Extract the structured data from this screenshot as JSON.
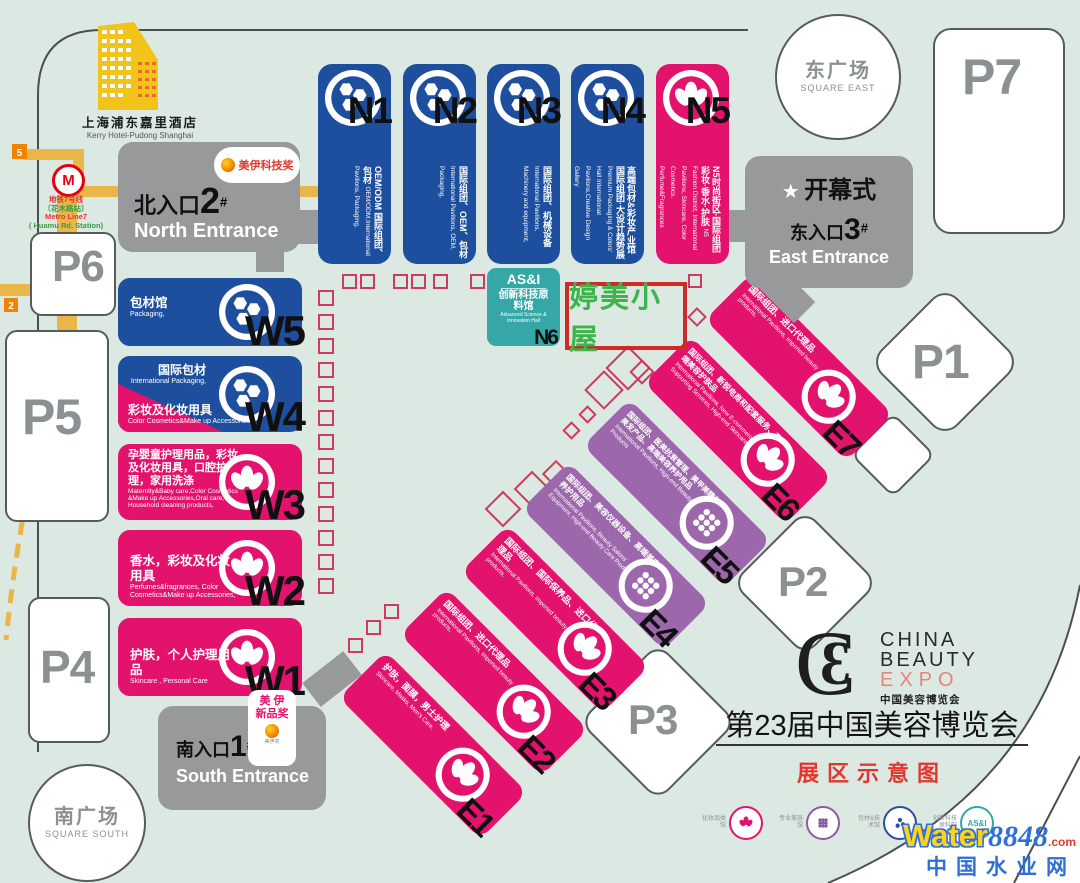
{
  "map_title": "第23届中国美容博览会",
  "map_subtitle": "展区示意图",
  "logo": {
    "mono_c": "C",
    "mono_b": "3",
    "line1": "CHINA",
    "line2": "BEAUTY",
    "line3": "EXPO",
    "line4": "中国美容博览会"
  },
  "hotel": {
    "zh": "上海浦东嘉里酒店",
    "en": "Kerry Hotel-Pudong Shanghai"
  },
  "metro": {
    "zh1": "地铁7号线",
    "zh2": "〔花木路站〕",
    "en1": "Metro Line7",
    "en2": "( Huamu Rd. Station)",
    "logo": "M",
    "badge5": "5",
    "badge1": "1",
    "badge2": "2"
  },
  "squares": {
    "east_zh": "东广场",
    "east_en": "SQUARE EAST",
    "south_zh": "南广场",
    "south_en": "SQUARE SOUTH"
  },
  "parking": {
    "p1": "P1",
    "p2": "P2",
    "p3": "P3",
    "p4": "P4",
    "p5": "P5",
    "p6": "P6",
    "p7": "P7"
  },
  "entrances": {
    "north": {
      "zh": "北入口",
      "num": "2",
      "sup": "#",
      "en": "North Entrance"
    },
    "east": {
      "star": "★",
      "ceremony": "开幕式",
      "zh": "东入口",
      "num": "3",
      "sup": "#",
      "en": "East Entrance"
    },
    "south": {
      "zh": "南入口",
      "num": "1",
      "sup": "#",
      "en": "South Entrance"
    }
  },
  "awards": {
    "tech": {
      "name": "美伊科技奖"
    },
    "new": {
      "line1": "美 伊",
      "line2": "新品奖",
      "tiny": "美伊奖"
    }
  },
  "highlight": {
    "text": "婷美小屋"
  },
  "halls": {
    "n": [
      {
        "id": "N1",
        "zh": "OEM/ODM 国际组团、包材",
        "en": "OEM/ODM,International Pavilions, Packaging,"
      },
      {
        "id": "N2",
        "zh": "国际组团、OEM、包材",
        "en": "International Pavilions, OEM, Packaging,"
      },
      {
        "id": "N3",
        "zh": "国际组团、机械设备",
        "en": "International Pavilions, Machinery and equipment,"
      },
      {
        "id": "N4",
        "zh": "高端包材&彩妆产业馆 国际组团·大设计趋势展",
        "en": "Premium Packaging & Colors' Hall International Pavilions,Creative Design Gallery"
      },
      {
        "id": "N5",
        "zh": "N5时尚街区·国际组团 彩妆·香水·护肤",
        "en": "N5 Fashion District, International Pavilions, Skincare, Color Cosmetics, Perfume&Fragrances"
      }
    ],
    "n6": {
      "brand": "AS&I",
      "zh1": "创新科技",
      "zh2": "原料馆",
      "en": "Advanced Science & Innovation Hall",
      "id": "N6"
    },
    "w": [
      {
        "id": "W5",
        "zh": "包材馆",
        "en": "Packaging,"
      },
      {
        "id": "W4",
        "zh2": "国际包材",
        "en2": "International Packaging,",
        "zh": "彩妆及化妆用具",
        "en": "Color Cosmetics&Make up Accessories,"
      },
      {
        "id": "W3",
        "zh": "孕婴童护理用品，彩妆及化妆用具，口腔护理，家用洗涤",
        "en": "Maternity&Baby care,Color Cosmetics &Make up Accessories,Oral care, Household cleaning products,"
      },
      {
        "id": "W2",
        "zh": "香水，彩妆及化妆用具",
        "en": "Perfumes&fragrances, Color Cosmetics&Make up Accessories,"
      },
      {
        "id": "W1",
        "zh": "护肤，个人护理用品",
        "en": "Skincare , Personal Care"
      }
    ],
    "e": [
      {
        "id": "E1",
        "zh": "护肤，面膜，男士护理",
        "en": "Skincare, Masks, Men's Care,"
      },
      {
        "id": "E2",
        "zh": "国际组团、进口代理品",
        "en": "International Pavilions, Imported beauty products,"
      },
      {
        "id": "E3",
        "zh": "国际组团、国际保养品、进口代理品",
        "en": "International Pavilions, Imported beauty products,"
      },
      {
        "id": "E4",
        "zh": "国际组团、美容仪器设备、高端美容养护用品",
        "en": "International Pavilions, Beauty Salons' Equipment, High-end Beauty Care Products"
      },
      {
        "id": "E5",
        "zh": "国际组团、医美抗衰管理、美甲美睫和美发产品、高端美容养护用品",
        "en": "International Pavilions, High-end Beauty Care Products"
      },
      {
        "id": "E6",
        "zh": "国际组团、新锐电商和配套服务、高端美容护肤品",
        "en": "International Pavilions, New E-commerce & Supporting Services, High-end Skincare"
      },
      {
        "id": "E7",
        "zh": "国际组团、进口代理品",
        "en": "International Pavilions, Imported beauty products,"
      }
    ]
  },
  "footer_logos": [
    {
      "label": "化妆品类馆"
    },
    {
      "label": "专业美容馆"
    },
    {
      "label": "包材&技术馆"
    },
    {
      "label": "创新科技原料馆",
      "brand": "AS&I"
    }
  ],
  "watermark": {
    "w": "Water",
    "n": "8848",
    "dotcom": ".com",
    "cn": "中国水业网"
  },
  "colors": {
    "blue": "#1d4f9e",
    "pink": "#e3126d",
    "purple": "#9c68ab",
    "teal": "#35a7a7",
    "entrance_gray": "#97999b",
    "marker_red": "#cc3a5e",
    "highlight_border": "#cf2a28",
    "highlight_text": "#3cb54a",
    "background": "#dce8e2"
  }
}
